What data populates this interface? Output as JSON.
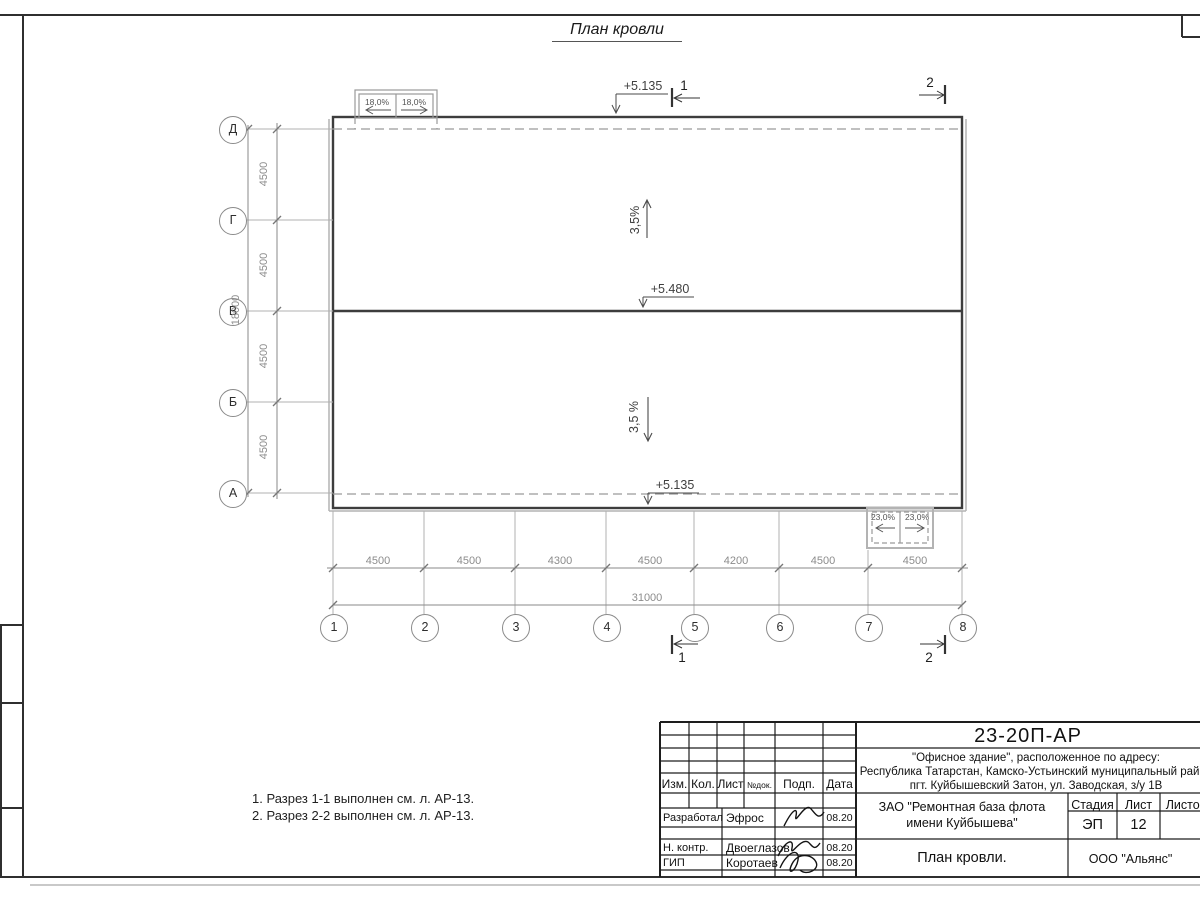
{
  "palette": {
    "ink": "#222222",
    "line_grey": "#8a8a8a",
    "dash_grey": "#9a9a9a"
  },
  "drawing": {
    "title": "План кровли",
    "notes": [
      "1. Разрез 1-1 выполнен см. л. АР-13.",
      "2. Разрез 2-2 выполнен см. л. АР-13."
    ]
  },
  "plan": {
    "row_axes": [
      "Д",
      "Г",
      "В",
      "Б",
      "А"
    ],
    "col_axes": [
      "1",
      "2",
      "3",
      "4",
      "5",
      "6",
      "7",
      "8"
    ],
    "span_dims_h": [
      "4500",
      "4500",
      "4300",
      "4500",
      "4200",
      "4500",
      "4500"
    ],
    "total_dim_h": "31000",
    "span_dims_v": [
      "4500",
      "4500",
      "4500",
      "4500"
    ],
    "total_dim_v": "18000",
    "elevation_top": "+5.135",
    "elevation_ridge": "+5.480",
    "elevation_bottom": "+5.135",
    "slope_upper": "3,5%",
    "slope_lower": "3,5 %",
    "canopy_top_left": "18,0%",
    "canopy_top_right": "18,0%",
    "canopy_bottom_left": "23,0%",
    "canopy_bottom_right": "23,0%",
    "section_1": "1",
    "section_2": "2"
  },
  "titleblock": {
    "doc_number": "23-20П-АР",
    "address": [
      "\"Офисное здание\", расположенное по адресу:",
      "Республика Татарстан, Камско-Устьинский муниципальный район",
      "пгт. Куйбышевский Затон, ул. Заводская, з/у 1В"
    ],
    "header_cols": [
      "Изм.",
      "Кол.",
      "Лист",
      "№док.",
      "Подп.",
      "Дата"
    ],
    "signers": [
      {
        "role": "Разработал",
        "name": "Эфрос",
        "date": "08.20"
      },
      {
        "role": "Н. контр.",
        "name": "Двоеглазов",
        "date": "08.20"
      },
      {
        "role": "ГИП",
        "name": "Коротаев",
        "date": "08.20"
      }
    ],
    "client_line1": "ЗАО \"Ремонтная база флота",
    "client_line2": "имени Куйбышева\"",
    "stage_label": "Стадия",
    "sheet_label": "Лист",
    "sheets_label": "Листов",
    "stage_value": "ЭП",
    "sheet_value": "12",
    "drawing_title": "План кровли.",
    "org": "ООО \"Альянс\""
  }
}
